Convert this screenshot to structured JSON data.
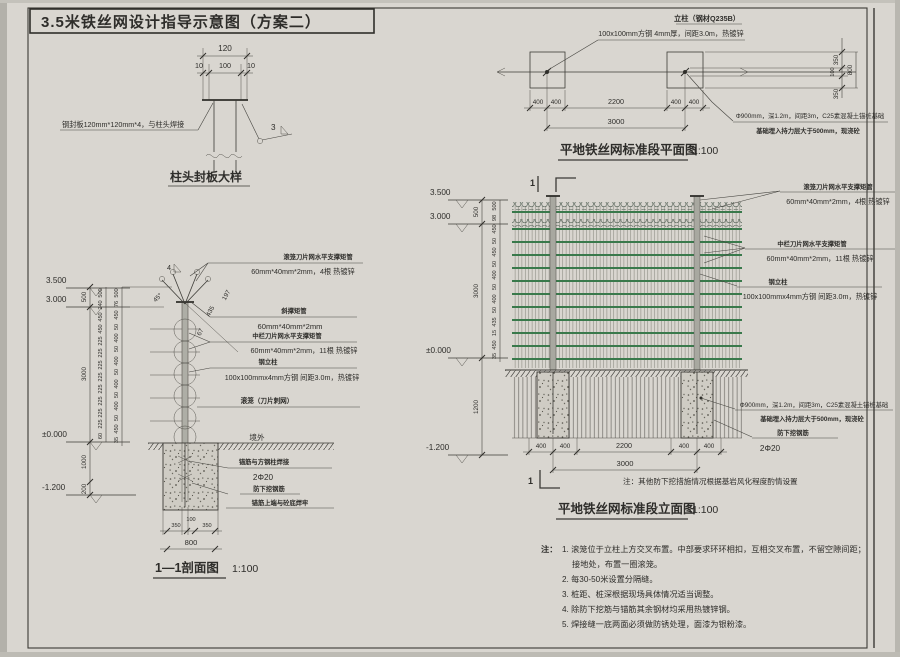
{
  "sheet_title": "3.5米铁丝网设计指导示意图（方案二）",
  "cap_detail": {
    "dims": {
      "total": "120",
      "left": "10",
      "mid": "100",
      "right": "10"
    },
    "plate_label": "钢封板120mm*120mm*4，与柱头焊接",
    "weld_mark": "3",
    "title": "柱头封板大样"
  },
  "section": {
    "levels": {
      "top": "3.500",
      "rail_top": "3.000",
      "ground": "±0.000",
      "bottom": "-1.200"
    },
    "chain_outer": [
      "500",
      "3000",
      "1000",
      "200"
    ],
    "chain_mid": [
      "500",
      "240",
      "450",
      "450",
      "225",
      "225",
      "225",
      "225",
      "225",
      "225",
      "225",
      "225",
      "60"
    ],
    "chain_inner": [
      "500",
      "76",
      "450",
      "50",
      "400",
      "50",
      "400",
      "50",
      "400",
      "50",
      "400",
      "50",
      "450",
      "35"
    ],
    "angle_label": "45°",
    "diag_dims": [
      "197",
      "435",
      "67"
    ],
    "weld_mark": "4",
    "labels": {
      "coil_support_title": "滚笼刀片网水平支撑矩管",
      "coil_support_spec": "60mm*40mm*2mm，4根 热镀锌",
      "brace_title": "斜撑矩管",
      "brace_spec": "60mm*40mm*2mm",
      "mid_support_title": "中栏刀片网水平支撑矩管",
      "mid_support_spec": "60mm*40mm*2mm，11根 热镀锌",
      "post_title": "钢立柱",
      "post_spec": "100x100mmx4mm方钢 间距3.0m，热镀锌",
      "coil_label": "滚笼（刀片刺网）",
      "outside_label": "境外",
      "anchor_title": "锚筋与方钢柱焊接",
      "anchor_spec": "2Φ20",
      "antidig_title": "防下挖钢筋",
      "antidig_spec": "锚筋上端与砼底焊牢"
    },
    "bottom_dims": {
      "d1": "350",
      "d2": "100",
      "d3": "350",
      "total": "800"
    },
    "title": "1—1剖面图",
    "scale": "1:100"
  },
  "plan": {
    "post_label_title": "立柱（钢材Q235B）",
    "post_label_spec": "100x100mm方钢 4mm厚，间距3.0m，热镀锌",
    "dims": [
      "400",
      "400",
      "2200",
      "400",
      "400"
    ],
    "total": "3000",
    "side_dims": [
      "350",
      "100",
      "800",
      "350"
    ],
    "foundation_label1": "Φ900mm，深1.2m，间距3m，C25素混凝土锚桩基础",
    "foundation_label2": "基础埋入持力层大于500mm，现浇砼",
    "title": "平地铁丝网标准段平面图",
    "scale": "1:100"
  },
  "elevation": {
    "levels": {
      "top": "3.500",
      "rail_top": "3.000",
      "ground": "±0.000",
      "bottom": "-1.200"
    },
    "chain_outer": [
      "500",
      "3000",
      "1200"
    ],
    "chain_inner": [
      "500",
      "98",
      "450",
      "50",
      "450",
      "50",
      "400",
      "50",
      "400",
      "50",
      "435",
      "15",
      "450",
      "35"
    ],
    "cut_mark": "1",
    "labels": {
      "coil_support_title": "滚笼刀片网水平支撑矩管",
      "coil_support_spec": "60mm*40mm*2mm，4根 热镀锌",
      "mid_support_title": "中栏刀片网水平支撑矩管",
      "mid_support_spec": "60mm*40mm*2mm，11根 热镀锌",
      "post_title": "钢立柱",
      "post_spec": "100x100mmx4mm方钢 间距3.0m，热镀锌",
      "foundation_label1": "Φ900mm，深1.2m，间距3m，C25素混凝土锚桩基础",
      "foundation_label2": "基础埋入持力层大于500mm，现浇砼",
      "antidig_title": "防下挖钢筋",
      "antidig_spec": "2Φ20"
    },
    "dims": [
      "400",
      "400",
      "2200",
      "400",
      "400"
    ],
    "total": "3000",
    "note": "注：其他防下挖措施情况根据基岩风化程度酌情设置",
    "title": "平地铁丝网标准段立面图",
    "scale": "1:100"
  },
  "notes": {
    "prefix": "注：",
    "items": [
      "1. 滚笼位于立柱上方交叉布置。中部要求环环相扣，互相交叉布置，不留空隙间距；",
      "接地处，布置一圈滚笼。",
      "2. 每30-50米设置分隔缝。",
      "3. 桩距、桩深根据现场具体情况适当调整。",
      "4. 除防下挖筋与锚筋其余钢材均采用热镀锌钢。",
      "5. 焊接缝一底两面必须做防锈处理，面漆为银粉漆。"
    ]
  },
  "colors": {
    "paper": "#d9d6d0",
    "ink": "#3c3b36",
    "green": "#39794b"
  }
}
